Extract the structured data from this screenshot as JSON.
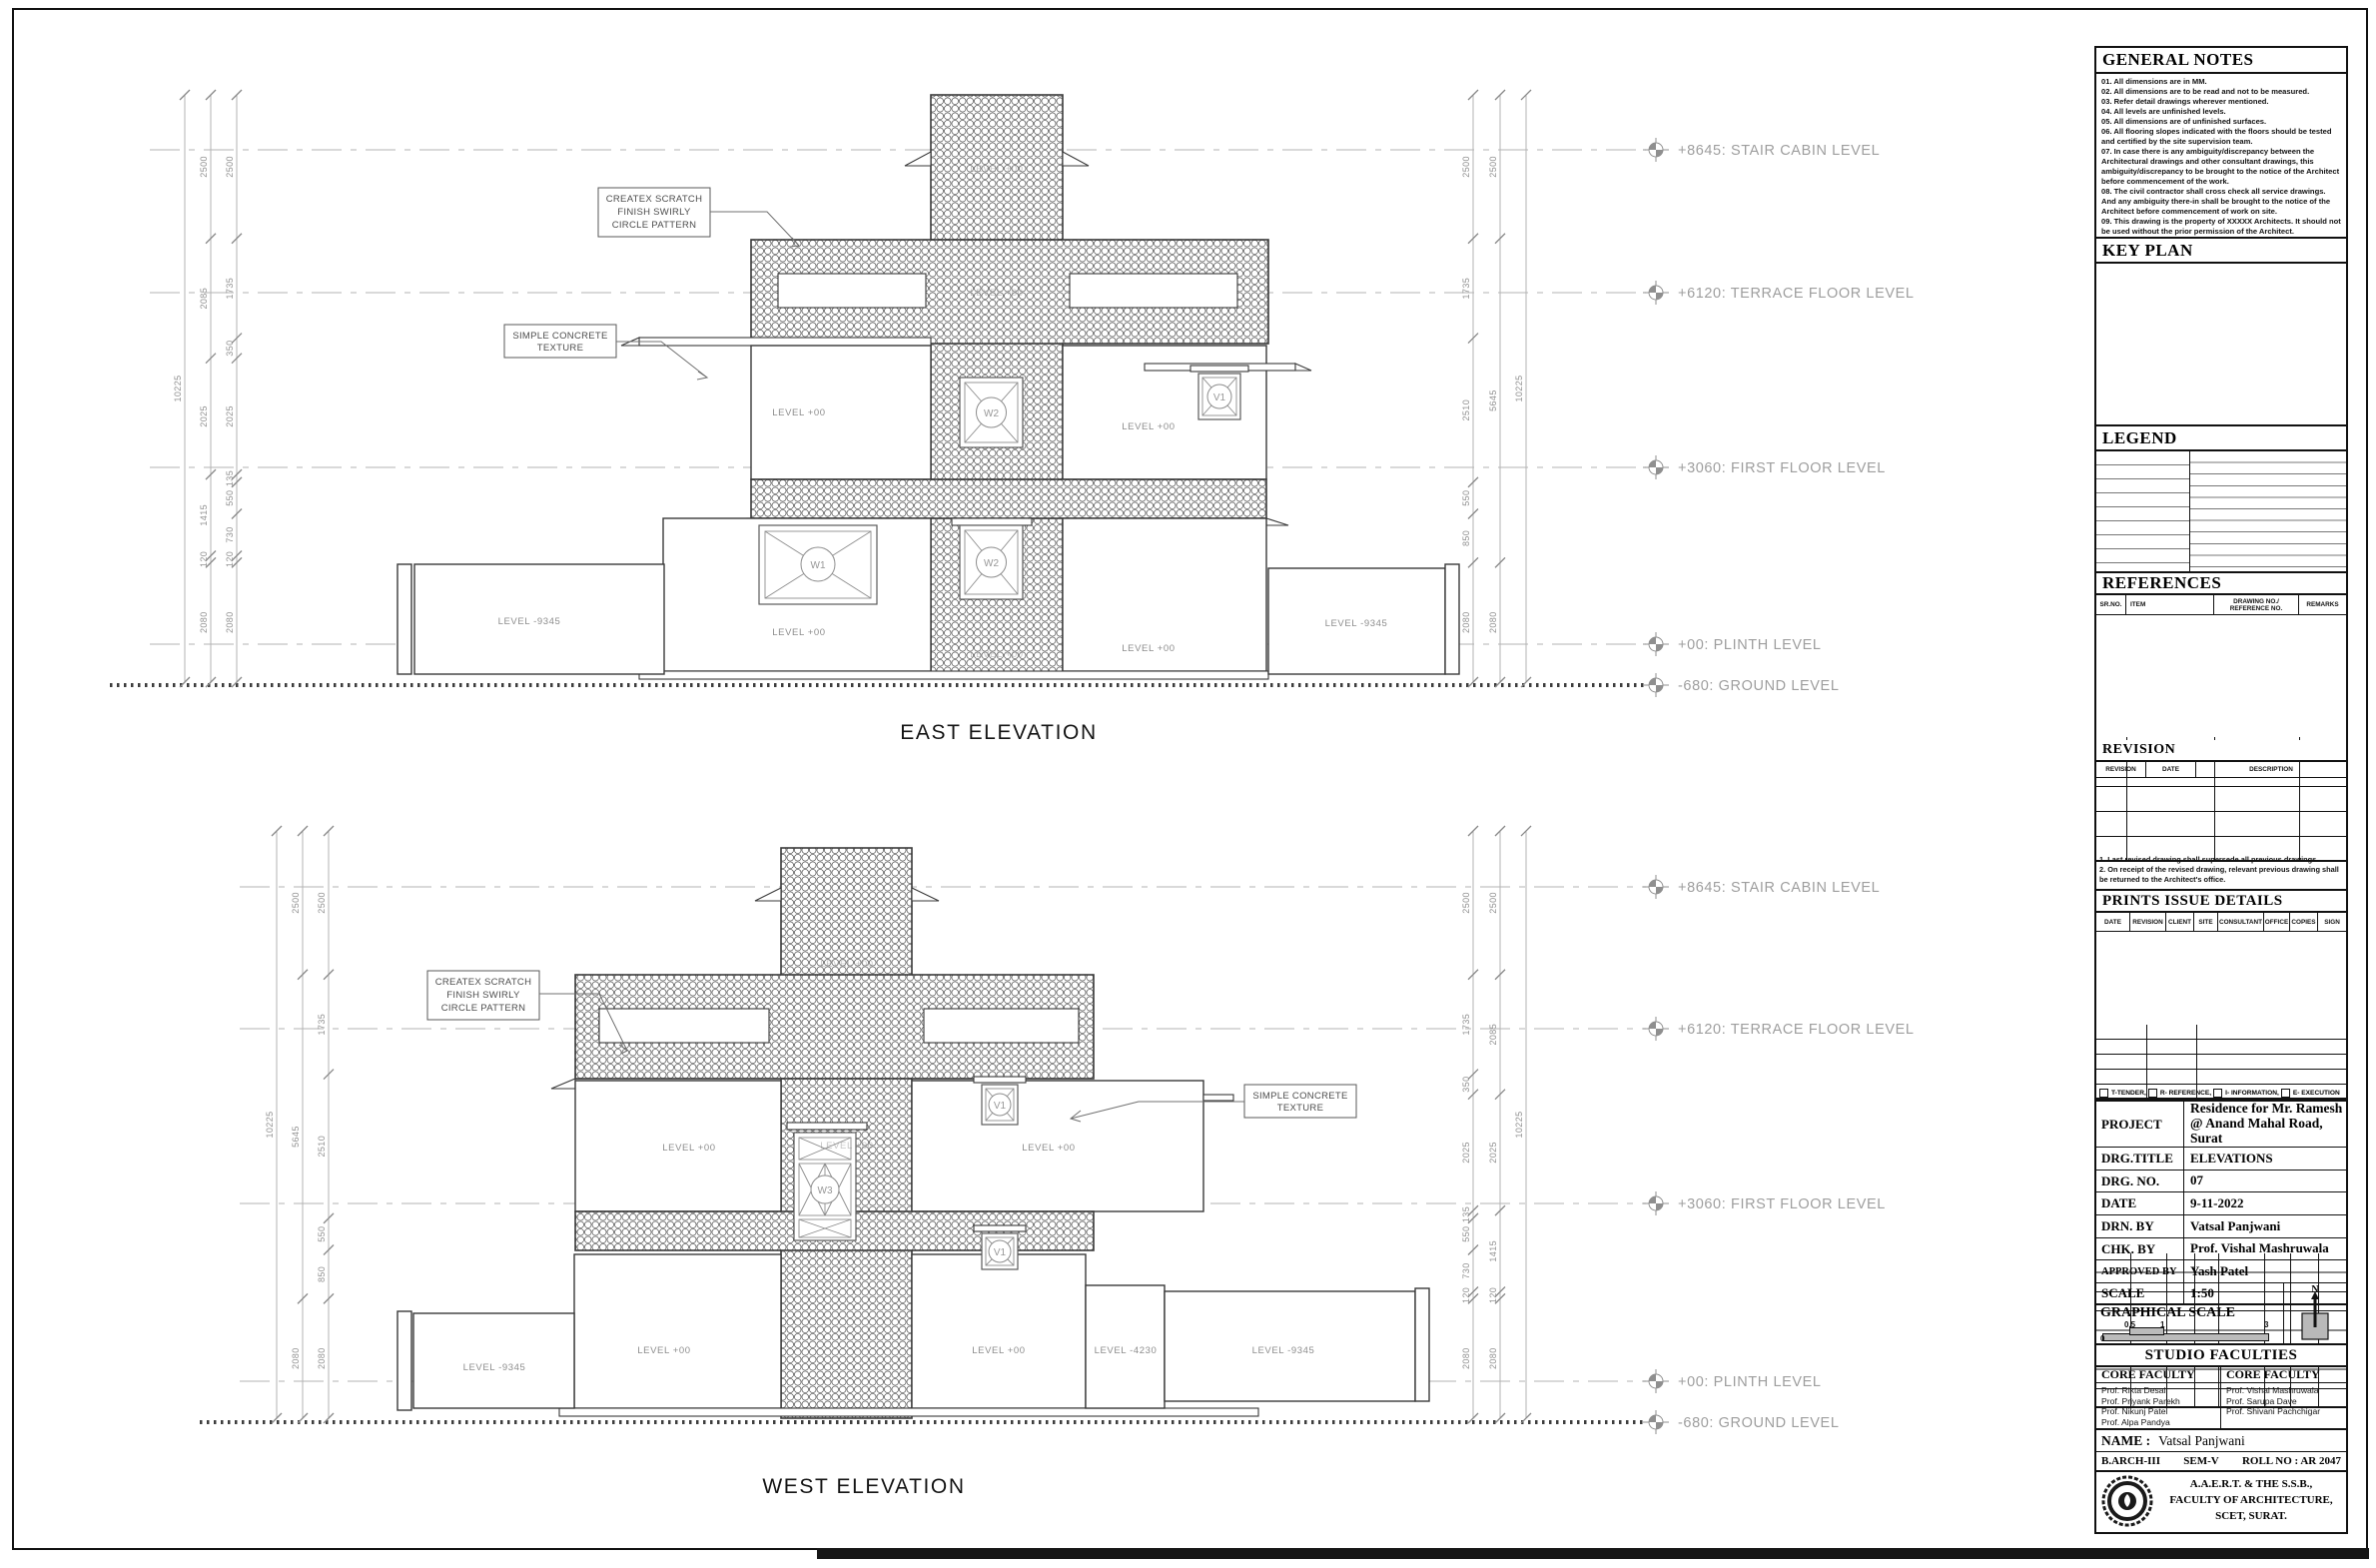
{
  "sheet": {
    "east_title": "EAST ELEVATION",
    "west_title": "WEST ELEVATION"
  },
  "levels": {
    "stair_cabin": "+8645: STAIR CABIN LEVEL",
    "terrace": "+6120: TERRACE FLOOR LEVEL",
    "first": "+3060: FIRST FLOOR LEVEL",
    "plinth": "+00: PLINTH LEVEL",
    "ground": "-680: GROUND LEVEL"
  },
  "annotations": {
    "createx": [
      "CREATEX SCRATCH",
      "FINISH SWIRLY",
      "CIRCLE PATTERN"
    ],
    "concrete": [
      "SIMPLE CONCRETE",
      "TEXTURE"
    ]
  },
  "room_labels": {
    "lvl00": "LEVEL  +00",
    "lvl_m9345": "LEVEL  -9345",
    "lvl_m4230": "LEVEL  -4230"
  },
  "window_tags": {
    "w1": "W1",
    "w2": "W2",
    "w3": "W3",
    "v1": "V1"
  },
  "dims": {
    "east_left_inner": [
      2500,
      1735,
      350,
      2025,
      135,
      550,
      730,
      120,
      2080
    ],
    "east_left_mid": [
      2500,
      2085,
      2025,
      1415,
      120,
      2080
    ],
    "east_left_outer": [
      10225
    ],
    "east_right_inner": [
      2500,
      1735,
      2510,
      550,
      850,
      2080
    ],
    "east_right_mid": [
      2500,
      5645,
      2080
    ],
    "east_right_outer": [
      10225
    ],
    "west_left_inner": [
      2500,
      1735,
      2510,
      550,
      850,
      2080
    ],
    "west_left_mid": [
      2500,
      5645,
      2080
    ],
    "west_left_outer": [
      10225
    ],
    "west_right_inner": [
      2500,
      1735,
      350,
      2025,
      135,
      550,
      730,
      120,
      2080
    ],
    "west_right_mid": [
      2500,
      2085,
      2025,
      1415,
      120,
      2080
    ],
    "west_right_outer": [
      10225
    ]
  },
  "titleblock": {
    "general_notes": {
      "title": "GENERAL NOTES",
      "notes": [
        "01. All dimensions are in MM.",
        "02. All dimensions are to be read and not to be measured.",
        "03. Refer detail drawings wherever mentioned.",
        "04. All levels are unfinished levels.",
        "05. All dimensions are of unfinished surfaces.",
        "06. All flooring slopes indicated with the floors should be tested and certified by the site supervision team.",
        "07. In case there is any ambiguity/discrepancy between the Architectural drawings and other consultant drawings, this ambiguity/discrepancy to be brought to the notice of the Architect before commencement of the work.",
        "08. The civil contractor shall cross check all service drawings. And any ambiguity there-in shall be brought to the notice of the Architect before commencement of work on site.",
        "09. This drawing is the property of XXXXX Architects. It should not be used without the prior permission of the Architect."
      ]
    },
    "key_plan_title": "KEY PLAN",
    "legend_title": "LEGEND",
    "references": {
      "title": "REFERENCES",
      "headers": [
        "SR.NO.",
        "ITEM",
        "DRAWING NO./ REFERENCE NO.",
        "REMARKS"
      ]
    },
    "revision": {
      "title": "REVISION",
      "headers": [
        "REVISION",
        "DATE",
        "DESCRIPTION"
      ],
      "notes": [
        "1. Last revised drawing shall supersede all previous drawings.",
        "2. On receipt of the revised drawing, relevant previous drawing shall",
        "be returned to the Architect's office."
      ]
    },
    "prints": {
      "title": "PRINTS ISSUE DETAILS",
      "headers": [
        "DATE",
        "REVISION",
        "CLIENT",
        "SITE",
        "CONSULTANT",
        "OFFICE",
        "COPIES",
        "SIGN"
      ]
    },
    "issue_types": [
      "T-TENDER,",
      "R- REFERENCE,",
      "I- INFORMATION,",
      "E- EXECUTION"
    ],
    "project_rows": [
      {
        "label": "PROJECT",
        "value": "Residence for Mr. Ramesh @ Anand Mahal Road, Surat"
      },
      {
        "label": "DRG.TITLE",
        "value": "ELEVATIONS"
      },
      {
        "label": "DRG. NO.",
        "value": "07"
      },
      {
        "label": "DATE",
        "value": "9-11-2022"
      },
      {
        "label": "DRN. BY",
        "value": "Vatsal Panjwani"
      },
      {
        "label": "CHK. BY",
        "value": "Prof. Vishal Mashruwala"
      },
      {
        "label": "APPROVED BY",
        "value": "Yash Patel"
      },
      {
        "label": "SCALE",
        "value": "1:50"
      }
    ],
    "graphical_scale": {
      "title": "GRAPHICAL SCALE",
      "ticks": [
        "0",
        "0.5",
        "1",
        "3"
      ],
      "north": "N"
    },
    "studio": {
      "title": "STUDIO FACULTIES",
      "col1_header": "CORE FACULTY",
      "col1": [
        "Prof. Rikta Desai",
        "Prof. Priyank Parekh",
        "Prof. Nikunj Patel",
        "Prof. Alpa Pandya"
      ],
      "col2_header": "CORE FACULTY",
      "col2": [
        "Prof. Vishal Mashruwala",
        "Prof. Sarupa Dave",
        "Prof. Shivani Pachchigar"
      ]
    },
    "name_row": {
      "label": "NAME :",
      "value": "Vatsal Panjwani"
    },
    "batch_row": {
      "course": "B.ARCH-III",
      "sem": "SEM-V",
      "roll": "ROLL NO : AR 2047"
    },
    "institute": [
      "A.A.E.R.T. & THE S.S.B.,",
      "FACULTY OF ARCHITECTURE,",
      "SCET, SURAT."
    ]
  }
}
